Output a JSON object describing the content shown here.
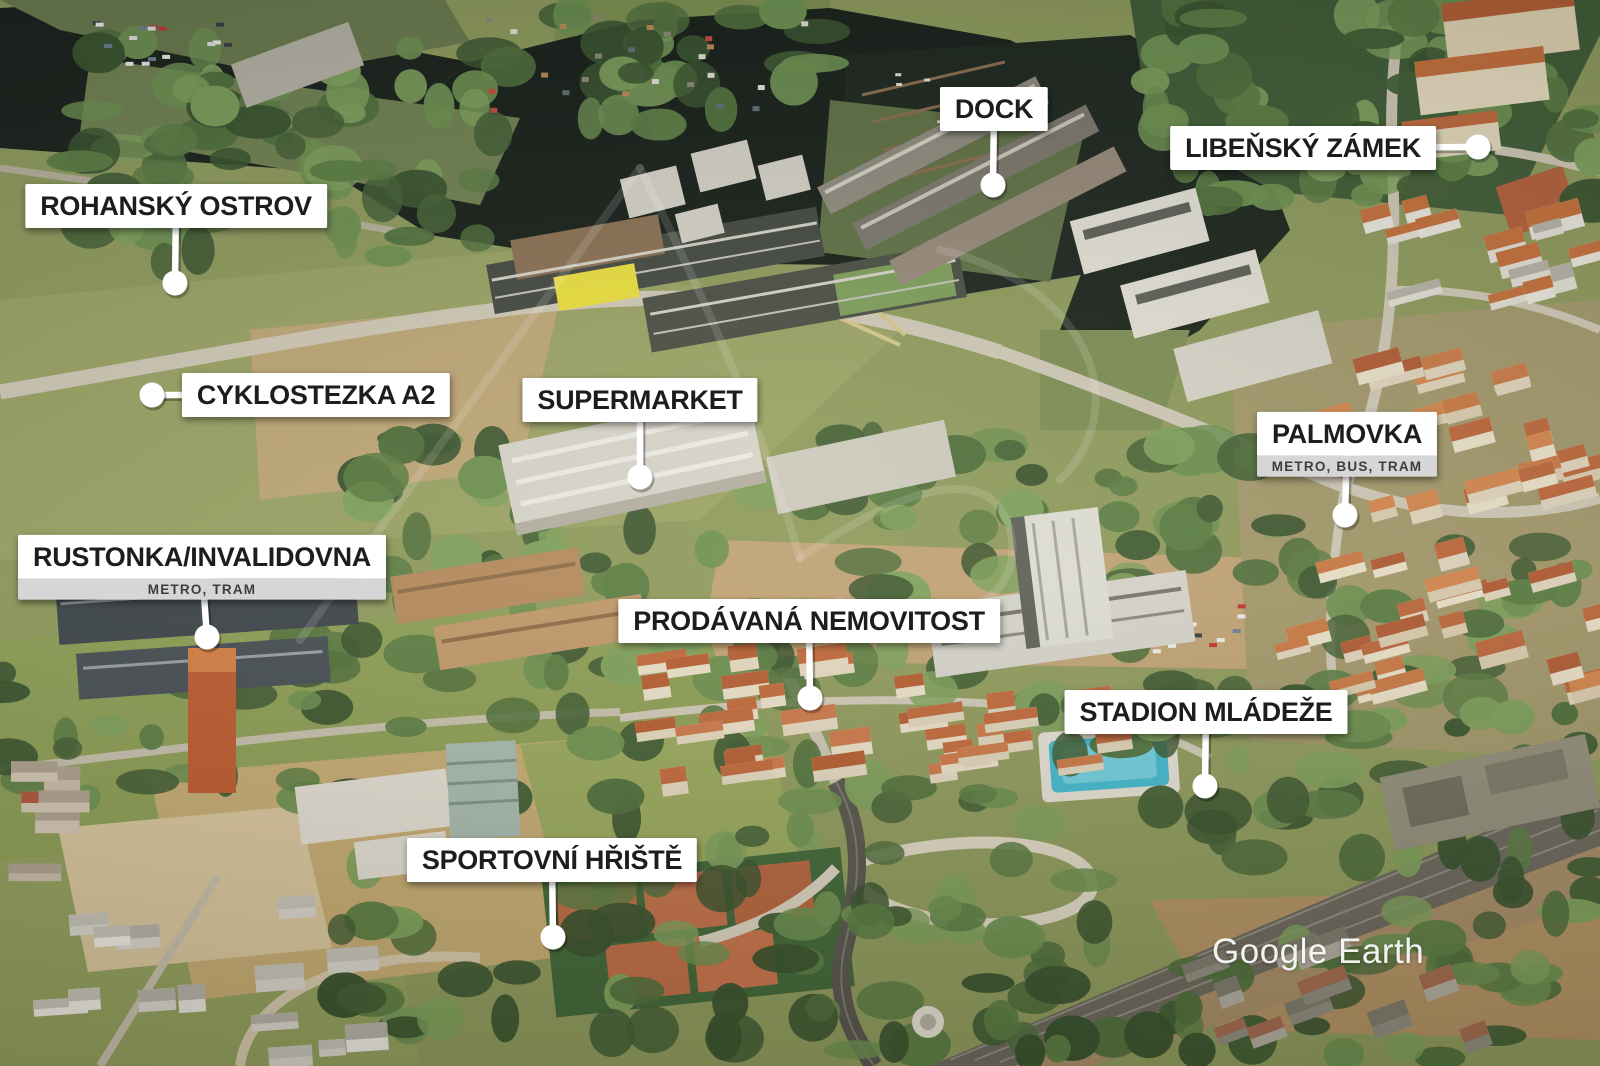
{
  "map": {
    "attribution": "Google Earth",
    "colors": {
      "label_bg": "#ffffff",
      "label_text": "#1d1d1b",
      "sublabel_bg": "#d6d6d6",
      "sublabel_text": "#3d3d3d",
      "connector": "#ffffff",
      "highlight_building": "#f0e33c"
    }
  },
  "markers": [
    {
      "id": "rohansky-ostrov",
      "label": "ROHANSKÝ OSTROV",
      "sublabel": null,
      "box": {
        "cx": 176,
        "cy": 206
      },
      "dot": {
        "x": 175,
        "y": 283
      },
      "attach": "bottom"
    },
    {
      "id": "dock",
      "label": "DOCK",
      "sublabel": null,
      "box": {
        "cx": 994,
        "cy": 109
      },
      "dot": {
        "x": 993,
        "y": 185
      },
      "attach": "bottom"
    },
    {
      "id": "libensky-zamek",
      "label": "LIBEŇSKÝ ZÁMEK",
      "sublabel": null,
      "box": {
        "cx": 1303,
        "cy": 148
      },
      "dot": {
        "x": 1478,
        "y": 147
      },
      "attach": "right"
    },
    {
      "id": "cyklostezka-a2",
      "label": "CYKLOSTEZKA A2",
      "sublabel": null,
      "box": {
        "cx": 316,
        "cy": 395
      },
      "dot": {
        "x": 152,
        "y": 395
      },
      "attach": "left"
    },
    {
      "id": "supermarket",
      "label": "SUPERMARKET",
      "sublabel": null,
      "box": {
        "cx": 640,
        "cy": 400
      },
      "dot": {
        "x": 640,
        "y": 477
      },
      "attach": "bottom"
    },
    {
      "id": "palmovka",
      "label": "PALMOVKA",
      "sublabel": "METRO, BUS, TRAM",
      "box": {
        "cx": 1347,
        "cy": 444
      },
      "dot": {
        "x": 1345,
        "y": 515
      },
      "attach": "bottom"
    },
    {
      "id": "rustonka-invalidovna",
      "label": "RUSTONKA/INVALIDOVNA",
      "sublabel": "METRO, TRAM",
      "box": {
        "cx": 202,
        "cy": 567
      },
      "dot": {
        "x": 207,
        "y": 637
      },
      "attach": "bottom"
    },
    {
      "id": "prodavana-nemovitost",
      "label": "PRODÁVANÁ NEMOVITOST",
      "sublabel": null,
      "box": {
        "cx": 809,
        "cy": 621
      },
      "dot": {
        "x": 810,
        "y": 698
      },
      "attach": "bottom"
    },
    {
      "id": "stadion-mladeze",
      "label": "STADION MLÁDEŽE",
      "sublabel": null,
      "box": {
        "cx": 1206,
        "cy": 712
      },
      "dot": {
        "x": 1205,
        "y": 786
      },
      "attach": "bottom"
    },
    {
      "id": "sportovni-hriste",
      "label": "SPORTOVNÍ HŘIŠTĚ",
      "sublabel": null,
      "box": {
        "cx": 552,
        "cy": 860
      },
      "dot": {
        "x": 553,
        "y": 937
      },
      "attach": "bottom"
    }
  ]
}
